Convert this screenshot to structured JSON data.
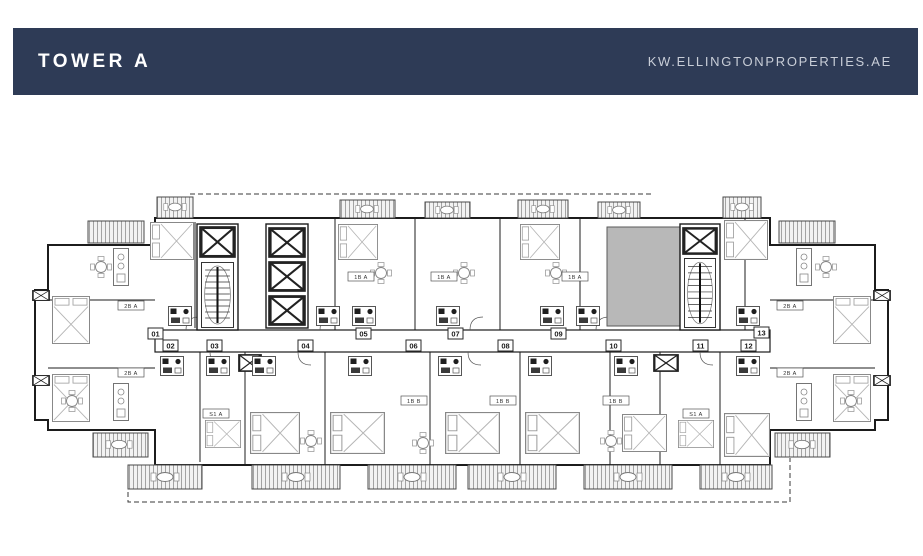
{
  "page": {
    "background_color": "#ffffff"
  },
  "header": {
    "title": "TOWER A",
    "website": "KW.ELLINGTONPROPERTIES.AE",
    "background_color": "#2e3b56",
    "title_color": "#ffffff",
    "website_color": "#c8cdd7"
  },
  "floor_plan": {
    "line_color": "#1c1c1c",
    "core_fill_color": "#b8b8b8",
    "balcony_hatch_color": "#a3a3a3",
    "units": [
      "01",
      "02",
      "03",
      "04",
      "05",
      "06",
      "07",
      "08",
      "09",
      "10",
      "11",
      "12",
      "13"
    ],
    "unit_type_tags": [
      "2B A",
      "1B A",
      "1B A",
      "1B A",
      "2B A",
      "2B A",
      "S1 A",
      "1B B",
      "1B B",
      "1B B",
      "S1 A",
      "2B A"
    ]
  }
}
